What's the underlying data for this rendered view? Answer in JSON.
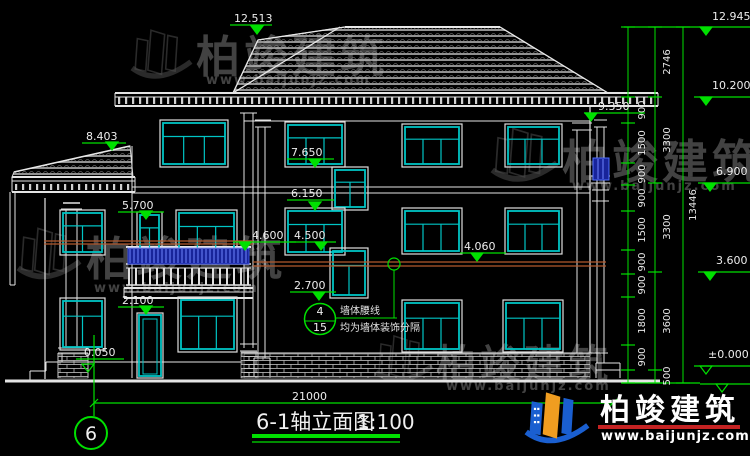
{
  "title": {
    "text": "6-1轴立面图",
    "scale": "1:100"
  },
  "axis": {
    "label": "6"
  },
  "overall_dim": {
    "label": "21000"
  },
  "brand": {
    "name": "柏竣建筑",
    "url": "www.baijunjz.com"
  },
  "callout": {
    "top": "4",
    "bottom": "15",
    "line1": "墙体腰线",
    "line2": "均为墙体装饰分隔"
  },
  "colors": {
    "green": "#00e000",
    "cyan": "#00c4c4",
    "white": "#e4e4e4",
    "red_belt": "#b35a2e",
    "blue_sel": "#18249a",
    "blue_bar": "#6e84ff",
    "logo_blue": "#1a5fd0",
    "logo_orange": "#f09d20",
    "logo_red": "#c42222",
    "watermark": "#9b9b9b"
  },
  "elevations": [
    {
      "label": "12.513",
      "x": 234,
      "y": 22,
      "ulx1": 230,
      "ulx2": 272,
      "uly": 25,
      "tipx": 257,
      "tipy": 34,
      "open": false
    },
    {
      "label": "8.403",
      "x": 86,
      "y": 140,
      "ulx1": 82,
      "ulx2": 126,
      "uly": 143,
      "tipx": 112,
      "tipy": 150,
      "open": false
    },
    {
      "label": "9.350",
      "x": 598,
      "y": 110,
      "ulx1": 584,
      "ulx2": 645,
      "uly": 113,
      "tipx": 591,
      "tipy": 121,
      "open": false
    },
    {
      "label": "7.650",
      "x": 291,
      "y": 156,
      "ulx1": 287,
      "ulx2": 334,
      "uly": 159,
      "tipx": 315,
      "tipy": 167,
      "open": false
    },
    {
      "label": "6.150",
      "x": 291,
      "y": 197,
      "ulx1": 287,
      "ulx2": 334,
      "uly": 200,
      "tipx": 315,
      "tipy": 210,
      "open": false
    },
    {
      "label": "5.700",
      "x": 122,
      "y": 209,
      "ulx1": 118,
      "ulx2": 164,
      "uly": 212,
      "tipx": 146,
      "tipy": 219,
      "open": false
    },
    {
      "label": "4.600",
      "x": 252,
      "y": 239,
      "ulx1": 233,
      "ulx2": 296,
      "uly": 242,
      "tipx": 245,
      "tipy": 250,
      "open": false
    },
    {
      "label": "4.500",
      "x": 294,
      "y": 239,
      "ulx1": 290,
      "ulx2": 336,
      "uly": 242,
      "tipx": 321,
      "tipy": 250,
      "open": false
    },
    {
      "label": "4.060",
      "x": 464,
      "y": 250,
      "ulx1": 460,
      "ulx2": 506,
      "uly": 253,
      "tipx": 477,
      "tipy": 261,
      "open": false
    },
    {
      "label": "2.700",
      "x": 294,
      "y": 289,
      "ulx1": 290,
      "ulx2": 336,
      "uly": 292,
      "tipx": 319,
      "tipy": 300,
      "open": false
    },
    {
      "label": "2.100",
      "x": 122,
      "y": 304,
      "ulx1": 118,
      "ulx2": 164,
      "uly": 307,
      "tipx": 146,
      "tipy": 314,
      "open": false
    },
    {
      "label": "-0.050",
      "x": 80,
      "y": 356,
      "ulx1": 76,
      "ulx2": 124,
      "uly": 359,
      "tipx": 88,
      "tipy": 372,
      "open": true
    }
  ],
  "flags": [
    {
      "label": "12.945",
      "x": 712,
      "y": 20,
      "lx1": 624,
      "ly": 27,
      "tipx": 706,
      "open": false
    },
    {
      "label": "10.200",
      "x": 712,
      "y": 89,
      "lx1": 694,
      "ly": 97,
      "tipx": 706,
      "open": false
    },
    {
      "label": "6.900",
      "x": 716,
      "y": 175,
      "lx1": 698,
      "ly": 183,
      "tipx": 710,
      "open": false
    },
    {
      "label": "3.600",
      "x": 716,
      "y": 264,
      "lx1": 698,
      "ly": 272,
      "tipx": 710,
      "open": false
    },
    {
      "label": "±0.000",
      "x": 708,
      "y": 358,
      "lx1": 694,
      "ly": 366,
      "tipx": 706,
      "open": true
    },
    {
      "label": "",
      "x": 740,
      "y": 376,
      "lx1": 700,
      "ly": 384,
      "tipx": 722,
      "open": true
    }
  ],
  "chains": {
    "l1": {
      "x": 628,
      "ticks": [
        27,
        97,
        123,
        163,
        185,
        211,
        250,
        274,
        297,
        345,
        370,
        383
      ],
      "labels": [
        {
          "t": "900",
          "y": 110
        },
        {
          "t": "1500",
          "y": 143
        },
        {
          "t": "900",
          "y": 174
        },
        {
          "t": "900",
          "y": 198
        },
        {
          "t": "1500",
          "y": 230
        },
        {
          "t": "900",
          "y": 262
        },
        {
          "t": "900",
          "y": 285
        },
        {
          "t": "1800",
          "y": 321
        },
        {
          "t": "900",
          "y": 357
        }
      ]
    },
    "l2": {
      "x": 655,
      "ticks": [
        27,
        97,
        183,
        272,
        370,
        383
      ],
      "labels": [
        {
          "t": "2746",
          "y": 62
        },
        {
          "t": "3300",
          "y": 140
        },
        {
          "t": "3300",
          "y": 227
        },
        {
          "t": "3600",
          "y": 321
        },
        {
          "t": "500",
          "y": 376
        }
      ]
    },
    "l3": {
      "x": 683,
      "ticks": [
        27,
        383
      ],
      "labels": [
        {
          "t": "13446",
          "y": 205
        }
      ]
    }
  },
  "drawing": {
    "white_lines": [
      [
        5,
        381,
        660,
        381,
        3
      ],
      [
        46,
        362,
        241,
        362,
        1
      ],
      [
        115,
        93,
        658,
        93,
        2
      ],
      [
        115,
        97,
        658,
        97,
        1
      ],
      [
        115,
        106,
        658,
        106,
        2
      ],
      [
        115,
        93,
        115,
        106,
        1
      ],
      [
        658,
        93,
        658,
        106,
        1
      ],
      [
        244,
        121,
        590,
        121,
        1
      ],
      [
        132,
        187,
        590,
        187,
        1
      ],
      [
        132,
        193,
        590,
        193,
        1
      ],
      [
        12,
        177,
        135,
        177,
        2
      ],
      [
        12,
        181,
        135,
        181,
        1
      ],
      [
        12,
        192,
        135,
        192,
        2
      ],
      [
        12,
        177,
        12,
        192,
        1
      ],
      [
        135,
        177,
        135,
        192,
        1
      ],
      [
        45,
        198,
        45,
        379,
        1.2
      ],
      [
        132,
        146,
        132,
        378,
        1
      ],
      [
        590,
        106,
        590,
        353,
        1.2
      ],
      [
        577,
        130,
        577,
        353,
        1
      ],
      [
        572,
        123,
        592,
        123,
        1
      ],
      [
        572,
        130,
        592,
        130,
        1
      ],
      [
        244,
        113,
        244,
        348,
        1
      ],
      [
        253,
        113,
        253,
        348,
        1
      ],
      [
        240,
        106,
        257,
        106,
        1
      ],
      [
        240,
        113,
        257,
        113,
        1
      ],
      [
        240,
        344,
        257,
        344,
        1
      ],
      [
        240,
        351,
        257,
        351,
        1
      ],
      [
        241,
        353,
        608,
        353,
        1
      ],
      [
        597,
        127,
        597,
        363,
        1
      ],
      [
        604,
        127,
        604,
        363,
        1
      ],
      [
        594,
        120,
        607,
        120,
        1
      ],
      [
        594,
        127,
        607,
        127,
        1
      ],
      [
        591,
        176,
        610,
        176,
        1
      ],
      [
        591,
        183,
        610,
        183,
        1
      ],
      [
        592,
        190,
        609,
        190,
        1
      ],
      [
        592,
        201,
        609,
        201,
        1
      ],
      [
        596,
        363,
        620,
        363,
        1
      ],
      [
        596,
        370,
        620,
        370,
        1
      ],
      [
        596,
        363,
        596,
        378,
        1
      ],
      [
        620,
        363,
        620,
        378,
        1
      ],
      [
        255,
        120,
        271,
        120,
        1
      ],
      [
        255,
        127,
        271,
        127,
        1
      ],
      [
        258,
        127,
        258,
        358,
        1
      ],
      [
        265,
        127,
        265,
        358,
        1
      ],
      [
        254,
        358,
        270,
        358,
        1
      ],
      [
        254,
        358,
        254,
        376,
        1
      ],
      [
        270,
        358,
        270,
        376,
        1
      ],
      [
        63,
        203,
        80,
        203,
        1.5
      ],
      [
        61,
        209,
        82,
        209,
        1
      ],
      [
        66,
        209,
        66,
        348,
        1
      ],
      [
        77,
        209,
        77,
        348,
        1
      ],
      [
        58,
        348,
        88,
        348,
        1
      ],
      [
        58,
        353,
        88,
        353,
        1
      ],
      [
        58,
        353,
        58,
        378,
        1
      ],
      [
        88,
        353,
        88,
        378,
        1
      ],
      [
        10,
        192,
        10,
        285,
        1
      ],
      [
        15,
        192,
        15,
        285,
        1
      ],
      [
        10,
        285,
        15,
        285,
        1
      ],
      [
        30,
        371,
        46,
        371,
        1
      ],
      [
        30,
        371,
        30,
        381,
        1
      ],
      [
        46,
        362,
        46,
        371,
        1
      ],
      [
        46,
        362,
        62,
        362,
        1
      ],
      [
        62,
        353,
        62,
        362,
        1
      ],
      [
        124,
        288,
        253,
        288,
        2
      ],
      [
        124,
        292,
        253,
        292,
        1
      ],
      [
        124,
        298,
        253,
        298,
        2
      ],
      [
        124,
        288,
        124,
        298,
        1
      ],
      [
        253,
        288,
        253,
        298,
        1
      ],
      [
        126,
        247,
        251,
        247,
        2
      ],
      [
        126,
        264,
        251,
        264,
        1.5
      ],
      [
        126,
        268,
        251,
        268,
        1
      ],
      [
        126,
        285,
        251,
        285,
        1.5
      ]
    ],
    "red_lines": [
      [
        44,
        241,
        253,
        241
      ],
      [
        44,
        244,
        253,
        244
      ],
      [
        253,
        262,
        606,
        262
      ],
      [
        253,
        266,
        606,
        266
      ]
    ],
    "roofs": [
      {
        "poly": [
          [
            233,
            93
          ],
          [
            258,
            40
          ],
          [
            345,
            27
          ],
          [
            500,
            27
          ],
          [
            608,
            93
          ]
        ],
        "edges": [
          [
            345,
            27,
            500,
            27,
            2
          ],
          [
            345,
            27,
            258,
            40,
            1.3
          ],
          [
            258,
            40,
            233,
            93,
            1.3
          ],
          [
            340,
            27,
            233,
            93,
            1.3
          ],
          [
            500,
            27,
            608,
            93,
            1.3
          ],
          [
            233,
            93,
            608,
            93,
            1
          ]
        ]
      },
      {
        "poly": [
          [
            12,
            177
          ],
          [
            14,
            172
          ],
          [
            130,
            146
          ],
          [
            133,
            177
          ]
        ],
        "edges": [
          [
            14,
            172,
            130,
            146,
            1.5
          ],
          [
            12,
            177,
            133,
            177,
            1
          ]
        ]
      }
    ],
    "dentil_rows": [
      {
        "x1": 118,
        "x2": 654,
        "y": 97,
        "h": 7,
        "step": 7
      },
      {
        "x1": 15,
        "x2": 131,
        "y": 184,
        "h": 6,
        "step": 7
      }
    ],
    "bricks": [
      [
        244,
        354,
        346,
        24
      ],
      [
        241,
        352,
        17,
        26
      ],
      [
        58,
        354,
        30,
        24
      ]
    ],
    "windows": [
      [
        160,
        120,
        68,
        47,
        2
      ],
      [
        60,
        210,
        45,
        45,
        1
      ],
      [
        137,
        212,
        25,
        45,
        1
      ],
      [
        176,
        210,
        61,
        47,
        2
      ],
      [
        60,
        298,
        45,
        52,
        1
      ],
      [
        178,
        297,
        59,
        55,
        2
      ],
      [
        285,
        122,
        60,
        45,
        2
      ],
      [
        402,
        124,
        60,
        43,
        2
      ],
      [
        505,
        124,
        57,
        43,
        2
      ],
      [
        332,
        167,
        36,
        43,
        1
      ],
      [
        285,
        208,
        60,
        47,
        2
      ],
      [
        402,
        208,
        60,
        46,
        2
      ],
      [
        505,
        208,
        57,
        46,
        2
      ],
      [
        330,
        248,
        38,
        50,
        1
      ],
      [
        402,
        300,
        60,
        52,
        2
      ],
      [
        503,
        300,
        60,
        52,
        2
      ]
    ],
    "door": [
      137,
      313,
      26,
      65
    ],
    "blue_collar": [
      593,
      158,
      16,
      22
    ],
    "balcony_rail": {
      "x": 128,
      "y": 248,
      "w": 121,
      "h": 16,
      "step": 4
    },
    "balusters": {
      "x1": 129,
      "x2": 249,
      "y1": 268,
      "y2": 285,
      "step": 7
    },
    "green_lines": [
      [
        94,
        416,
        94,
        335,
        1.2
      ],
      [
        94,
        403,
        613,
        403,
        1.2
      ],
      [
        90,
        407,
        98,
        399,
        1.2
      ],
      [
        609,
        407,
        617,
        399,
        1.2
      ],
      [
        628,
        27,
        628,
        383,
        1
      ],
      [
        655,
        27,
        655,
        383,
        1
      ],
      [
        683,
        27,
        683,
        383,
        1
      ],
      [
        622,
        383,
        700,
        383,
        1.2
      ],
      [
        305,
        321,
        335,
        321,
        1
      ],
      [
        335,
        318,
        397,
        318,
        1
      ],
      [
        394,
        318,
        394,
        270,
        1
      ]
    ],
    "green_circles": [
      {
        "cx": 320,
        "cy": 319,
        "r": 15.5,
        "w": 1.5
      },
      {
        "cx": 394,
        "cy": 264,
        "r": 6,
        "w": 1.2
      },
      {
        "cx": 91,
        "cy": 433,
        "r": 16,
        "w": 2
      }
    ],
    "title_bars": [
      [
        252,
        436,
        400,
        436,
        4
      ],
      [
        252,
        442,
        400,
        442,
        1.2
      ]
    ],
    "dim_label_pos": {
      "x": 292,
      "y": 400
    },
    "title_pos": {
      "x": 256,
      "y": 429,
      "scale_x": 357
    },
    "axis_pos": {
      "x": 91,
      "y": 440
    },
    "callout_pos": {
      "top_x": 320,
      "top_y": 315,
      "bot_x": 320,
      "bot_y": 331,
      "l1_x": 340,
      "l1_y": 314,
      "l2_x": 340,
      "l2_y": 331
    },
    "logo": {
      "icon_x": 524,
      "icon_y": 388,
      "brand_x": 600,
      "brand_y": 420,
      "bar": [
        598,
        425,
        142,
        4
      ],
      "url_x": 601,
      "url_y": 440
    },
    "watermarks": [
      {
        "ix": 16,
        "iy": 224,
        "s": 1.1,
        "tx": 86,
        "ty": 275,
        "ts": 46,
        "ux": 94,
        "uy": 292
      },
      {
        "ix": 130,
        "iy": 26,
        "s": 1.05,
        "tx": 196,
        "ty": 72,
        "ts": 44,
        "ux": 206,
        "uy": 84
      },
      {
        "ix": 490,
        "iy": 124,
        "s": 1.15,
        "tx": 562,
        "ty": 178,
        "ts": 46,
        "ux": 572,
        "uy": 190
      },
      {
        "ix": 374,
        "iy": 332,
        "s": 1.0,
        "tx": 436,
        "ty": 378,
        "ts": 40,
        "ux": 446,
        "uy": 390
      }
    ]
  }
}
